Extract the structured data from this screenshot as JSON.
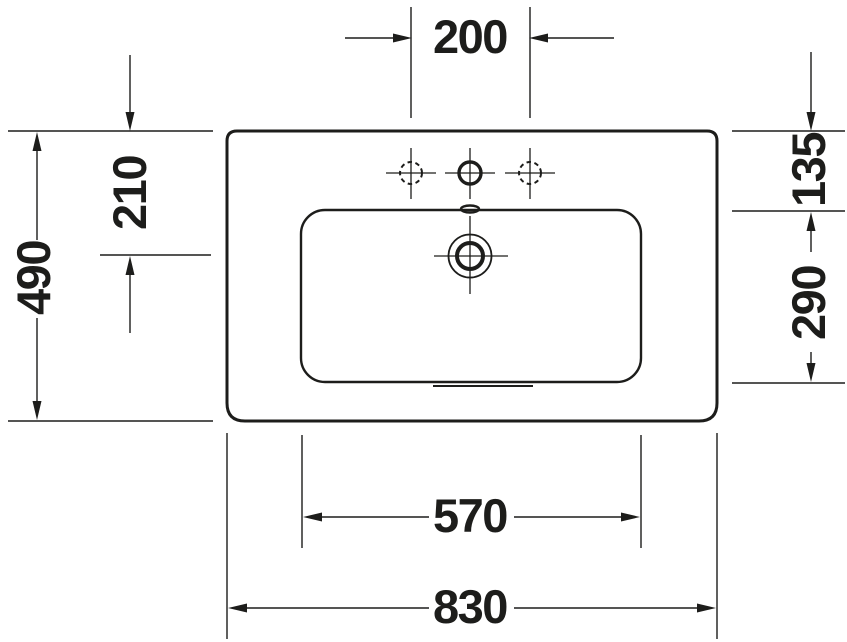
{
  "drawing": {
    "subject": "washbasin-top-view-dimension-drawing",
    "colors": {
      "line": "#1d1d1b",
      "background": "#ffffff"
    },
    "dimensions": {
      "tap_hole_spacing": "200",
      "overall_depth": "490",
      "front_edge_to_drain": "210",
      "rear_edge_to_bowl": "135",
      "bowl_front_to_back": "290",
      "bowl_width": "570",
      "overall_width": "830"
    },
    "features": {
      "tap_holes": {
        "count": 3,
        "center_style": "solid",
        "side_style": "dashed"
      }
    }
  }
}
